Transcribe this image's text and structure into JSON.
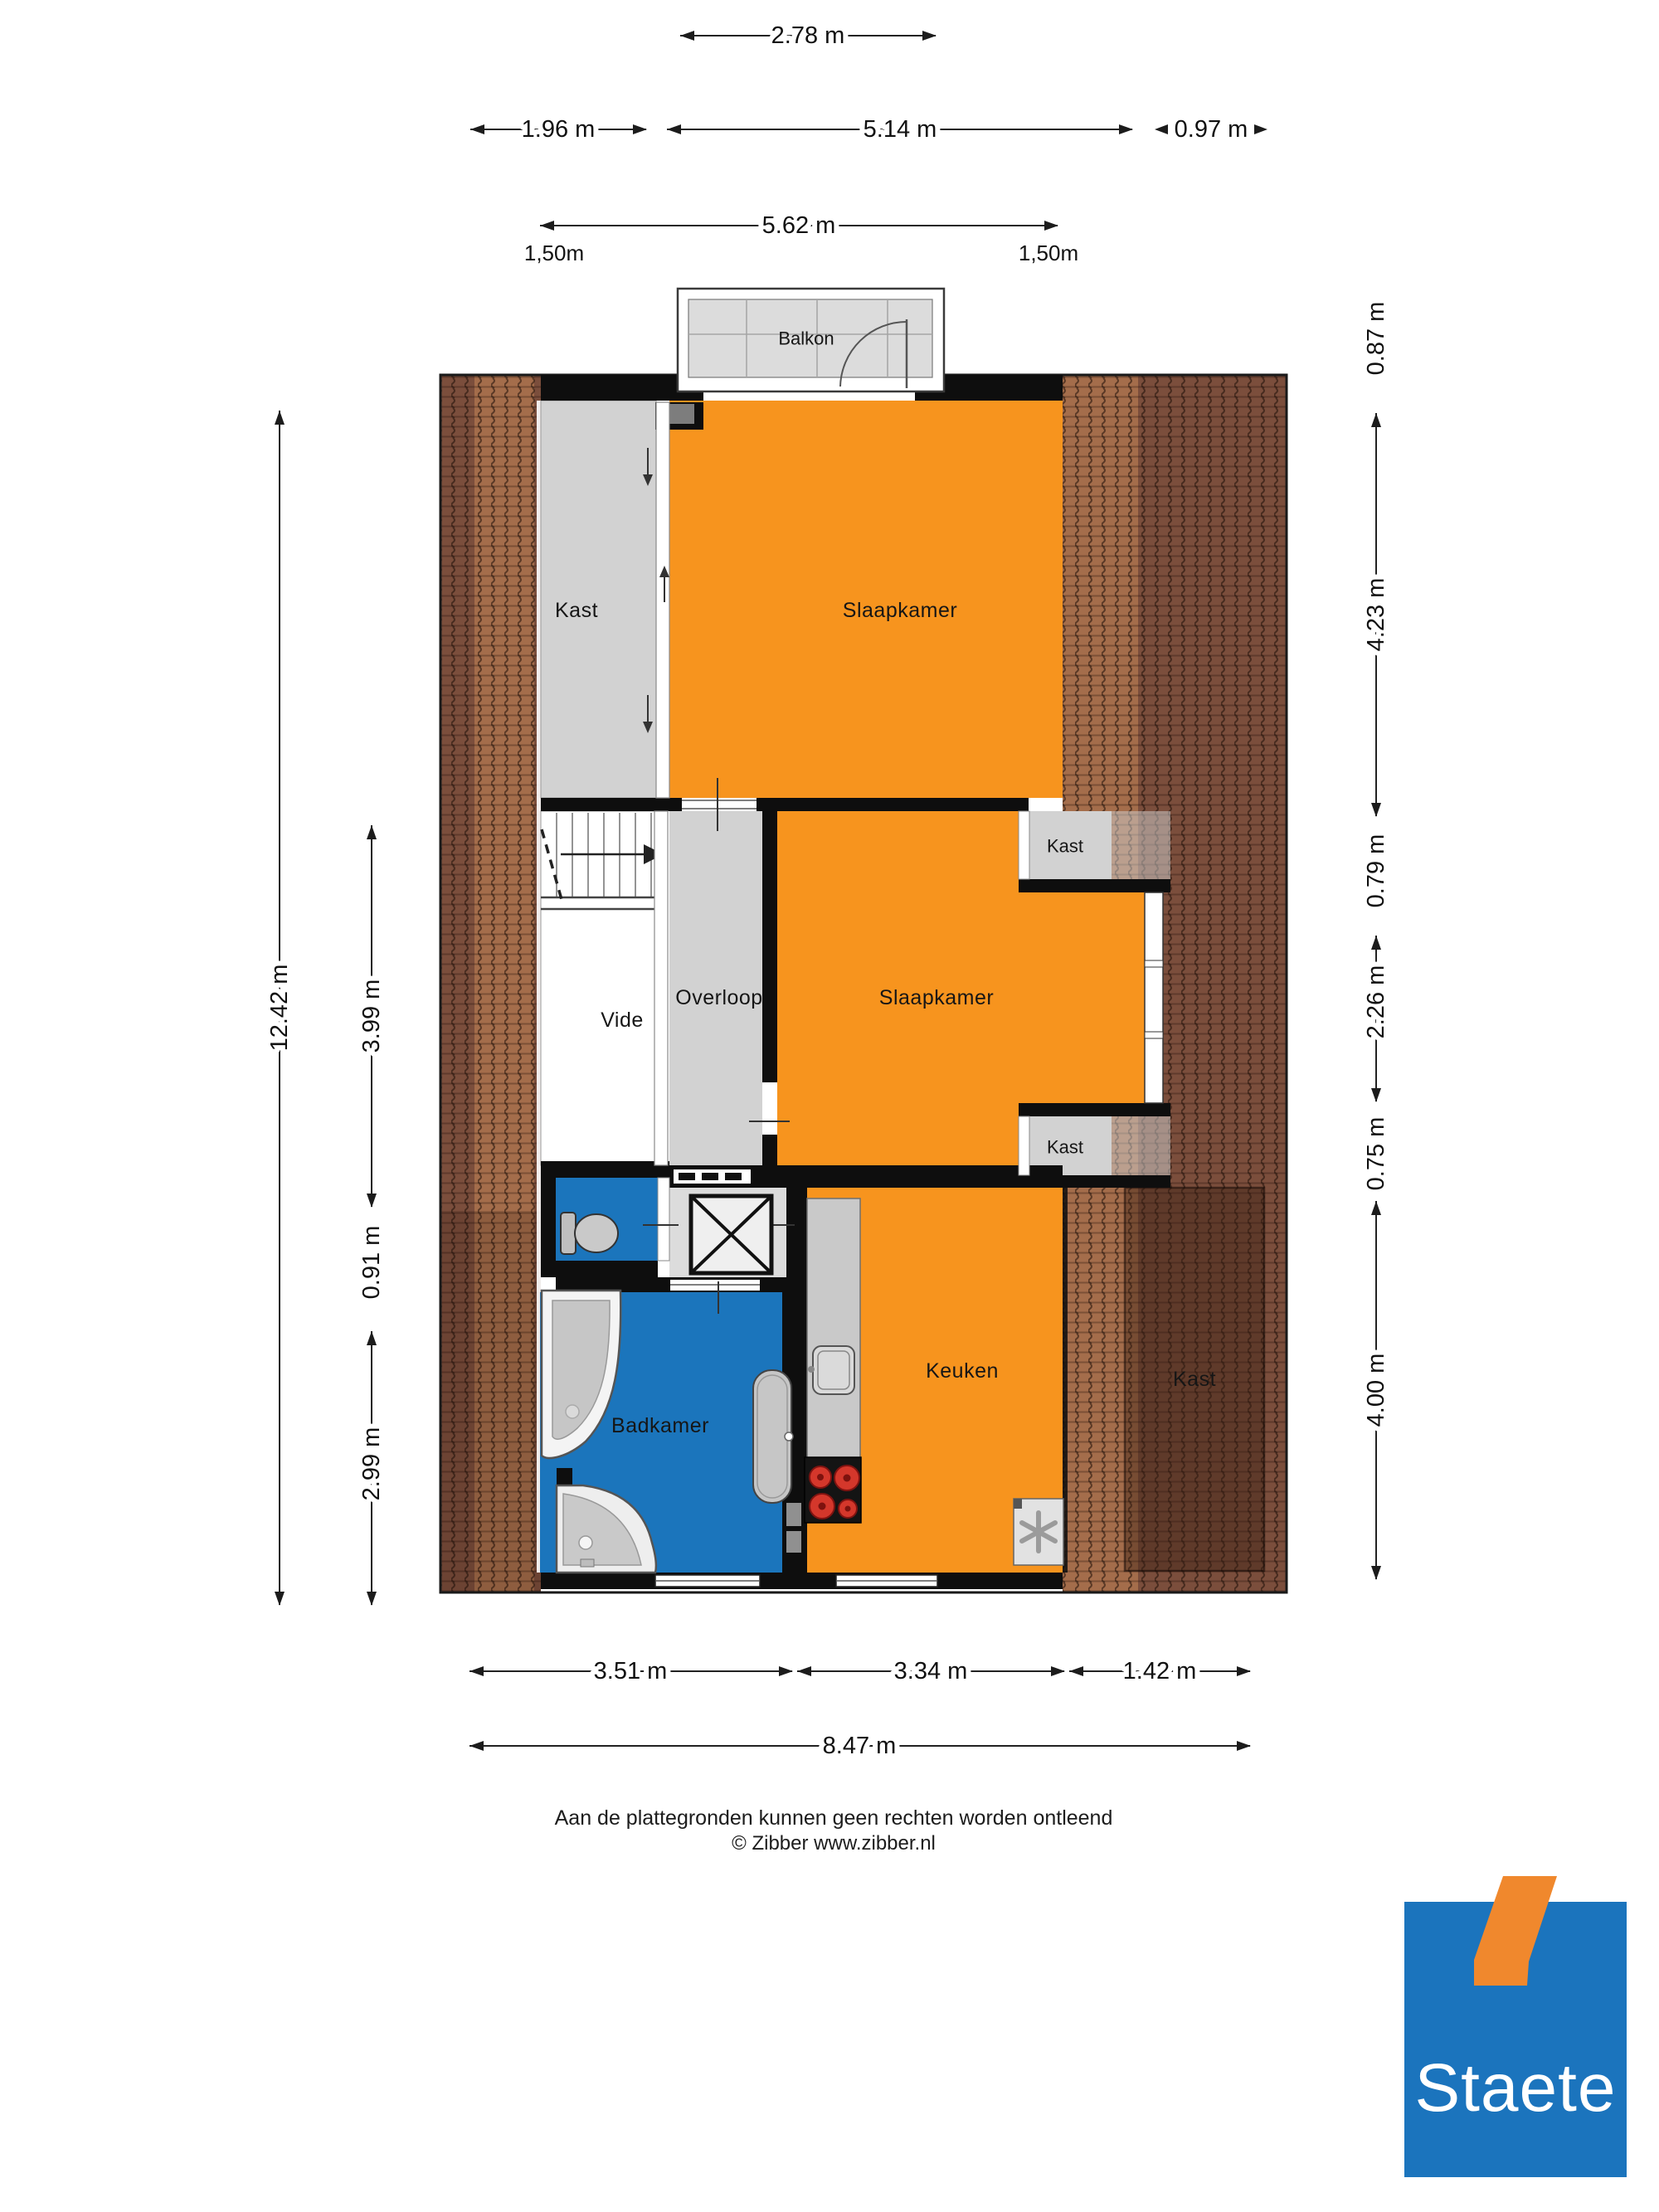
{
  "rooms": {
    "balkon": "Balkon",
    "kast_links": "Kast",
    "slaapkamer_1": "Slaapkamer",
    "kast_rechts_boven": "Kast",
    "slaapkamer_2": "Slaapkamer",
    "kast_rechts_onder": "Kast",
    "vide": "Vide",
    "overloop": "Overloop",
    "badkamer": "Badkamer",
    "keuken": "Keuken",
    "kast_rechtsonder_groot": "Kast"
  },
  "dimensions": {
    "top": [
      "2.78 m",
      "1.96 m",
      "5.14 m",
      "0.97 m",
      "5.62 m",
      "1,50m",
      "1,50m"
    ],
    "left": [
      "12.42 m",
      "3.99 m",
      "0.91 m",
      "2.99 m"
    ],
    "right": [
      "0.87 m",
      "4.23 m",
      "0.79 m",
      "2.26 m",
      "0.75 m",
      "4.00 m"
    ],
    "bottom": [
      "3.51 m",
      "3.34 m",
      "1.42 m",
      "8.47 m"
    ]
  },
  "footer": {
    "disclaimer": "Aan de plattegronden kunnen geen rechten worden ontleend",
    "copyright": "© Zibber www.zibber.nl"
  },
  "logo": {
    "text": "Staete"
  },
  "colors": {
    "room_orange": "#F7941E",
    "room_blue": "#1B75BC",
    "room_gray": "#D2D2D2",
    "tile_gray": "#DCDCDC",
    "roof_base": "#7B4E3C",
    "roof_light": "#A9714C",
    "wall_black": "#0E0E0E",
    "burner_red": "#D4372B",
    "logo_blue": "#1B74BD",
    "logo_orange": "#F0882D"
  }
}
